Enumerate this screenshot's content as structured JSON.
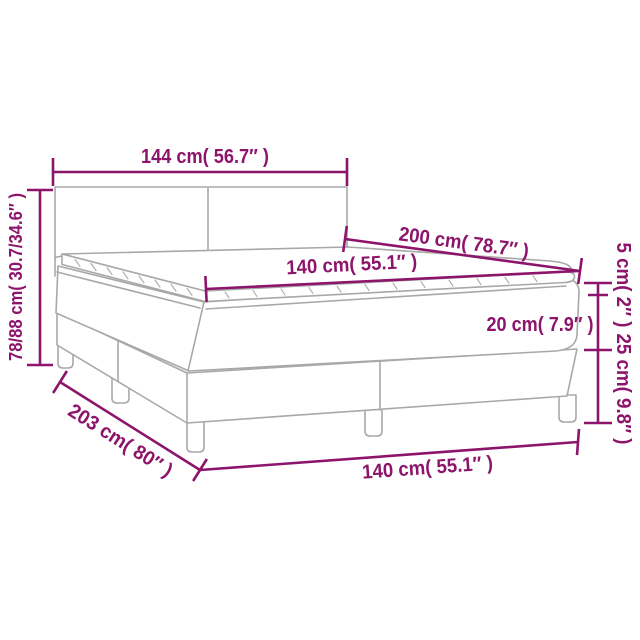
{
  "diagram": {
    "kind": "product-dimension-diagram",
    "subject": "box spring bed with headboard, mattress and topper",
    "background_color": "#ffffff",
    "accent_color": "#8d146b",
    "drawing_color": "#a8a8a8",
    "dimensions": [
      {
        "id": "headboard-width",
        "label": "144 cm( 56.7″ )"
      },
      {
        "id": "overall-height",
        "label": "78/88 cm( 30.7/34.6″ )"
      },
      {
        "id": "bed-length",
        "label": "200 cm( 78.7″ )"
      },
      {
        "id": "mattress-width",
        "label": "140 cm( 55.1″ )"
      },
      {
        "id": "topper-height",
        "label": "5 cm( 2″ )"
      },
      {
        "id": "mattress-height",
        "label": "20 cm( 7.9″ )"
      },
      {
        "id": "box-height",
        "label": "25 cm( 9.8″ )"
      },
      {
        "id": "base-length",
        "label": "203 cm( 80″ )"
      },
      {
        "id": "base-width",
        "label": "140 cm( 55.1″ )"
      }
    ]
  }
}
